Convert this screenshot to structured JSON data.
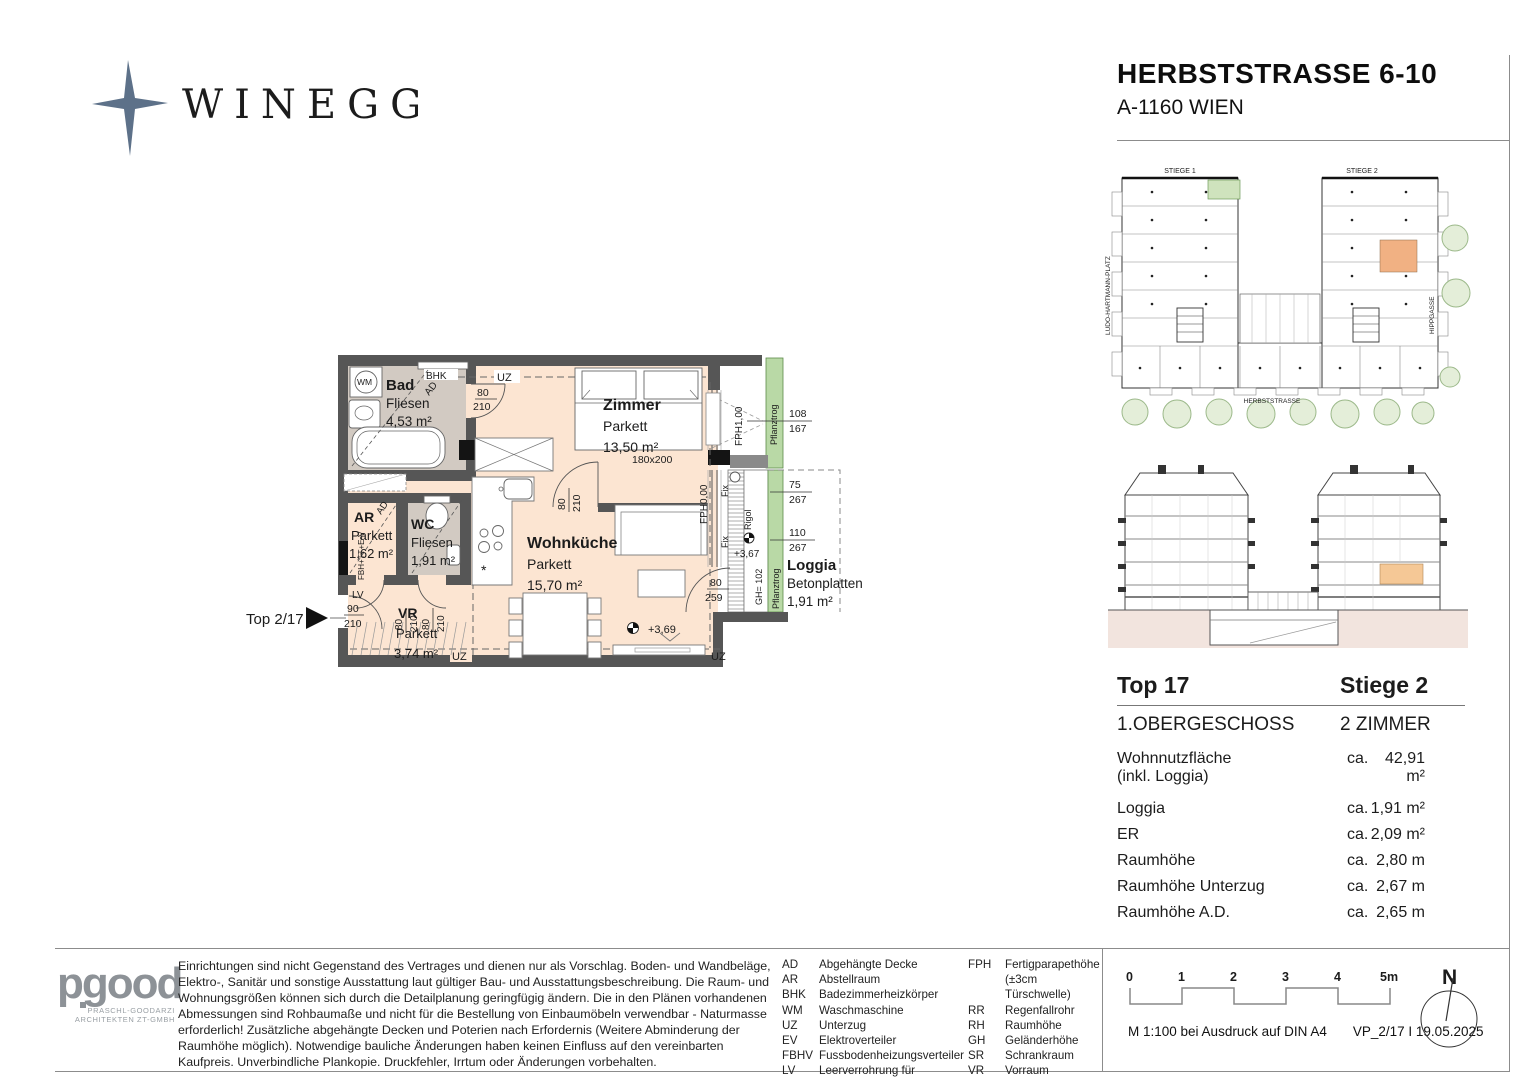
{
  "brand": {
    "name": "WINEGG",
    "color": "#5d7189"
  },
  "title": {
    "line1": "HERBSTSTRASSE 6-10",
    "line2": "A-1160 WIEN"
  },
  "site": {
    "stiege1": "STIEGE 1",
    "stiege2": "STIEGE 2",
    "left": "LUDO-HARTMANN-PLATZ",
    "right": "HIPPGASSE",
    "bottom": "HERBSTSTRASSE",
    "highlight_color": "#f1b183"
  },
  "plan": {
    "rooms": {
      "bad": {
        "name": "Bad",
        "floor": "Fliesen",
        "area": "4,53 m²"
      },
      "zimmer": {
        "name": "Zimmer",
        "floor": "Parkett",
        "area": "13,50 m²",
        "bed": "180x200"
      },
      "ar": {
        "name": "AR",
        "floor": "Parkett",
        "area": "1,62 m²"
      },
      "wc": {
        "name": "WC",
        "floor": "Fliesen",
        "area": "1,91 m²"
      },
      "vr": {
        "name": "VR",
        "floor": "Parkett",
        "area": "3,74 m²"
      },
      "wohn": {
        "name": "Wohnküche",
        "floor": "Parkett",
        "area": "15,70 m²"
      },
      "loggia": {
        "name": "Loggia",
        "floor": "Betonplatten",
        "area": "1,91 m²"
      }
    },
    "ann": {
      "wm": "WM",
      "bhk": "BHK",
      "uz": "UZ",
      "ad": "AD",
      "lv": "LV",
      "fbh": "FBH+TT+E-V",
      "fph1": "FPH1,00",
      "fph0": "FPH0,00",
      "fix": "Fix",
      "rigol": "Rigol",
      "pflanz": "Pflanztrog",
      "gh": "GH= 102",
      "lvl1": "+3,69",
      "lvl2": "+3,67",
      "top": "Top 2/17"
    },
    "dims": {
      "d80": "80",
      "d90": "90",
      "d210": "210",
      "d259": "259",
      "d75": "75",
      "d108": "108",
      "d110": "110",
      "d167": "167",
      "d267": "267"
    }
  },
  "info": {
    "top": "Top 17",
    "stiege": "Stiege 2",
    "floor": "1.OBERGESCHOSS",
    "rooms": "2 ZIMMER",
    "rows": [
      {
        "label": "Wohnnutzfläche",
        "label2": "(inkl. Loggia)",
        "prefix": "ca.",
        "value": "42,91 m²"
      },
      {
        "label": "Loggia",
        "prefix": "ca.",
        "value": "1,91 m²"
      },
      {
        "label": "ER",
        "prefix": "ca.",
        "value": "2,09 m²"
      },
      {
        "label": "Raumhöhe",
        "prefix": "ca.",
        "value": "2,80 m"
      },
      {
        "label": "Raumhöhe Unterzug",
        "prefix": "ca.",
        "value": "2,67 m"
      },
      {
        "label": "Raumhöhe A.D.",
        "prefix": "ca.",
        "value": "2,65 m"
      }
    ]
  },
  "footer": {
    "arch": {
      "logo": "pgood",
      "line1": "PRASCHL-GOODARZI",
      "line2": "ARCHITEKTEN ZT-GMBH"
    },
    "disclaimer": "Einrichtungen sind nicht Gegenstand des Vertrages und dienen nur als Vorschlag. Boden- und Wandbeläge, Elektro-, Sanitär und sonstige Ausstattung laut gültiger Bau- und Ausstattungsbeschreibung. Die Raum- und Wohnungsgrößen können sich durch die Detailplanung geringfügig ändern. Die in den Plänen vorhandenen Abmessungen sind Rohbaumaße und nicht für die Bestellung von Einbaumöbeln verwendbar - Naturmasse erforderlich! Zusätzliche abgehängte Decken und Poterien nach Erfordernis (Weitere Abminderung der Raumhöhe möglich). Notwendige bauliche Änderungen haben keinen Einfluss auf den vereinbarten Kaufpreis. Unverbindliche Plankopie. Druckfehler, Irrtum oder Änderungen vorbehalten.",
    "legend1": [
      {
        "a": "AD",
        "t": "Abgehängte Decke"
      },
      {
        "a": "AR",
        "t": "Abstellraum"
      },
      {
        "a": "BHK",
        "t": "Badezimmerheizkörper"
      },
      {
        "a": "WM",
        "t": "Waschmaschine"
      },
      {
        "a": "UZ",
        "t": "Unterzug"
      },
      {
        "a": "EV",
        "t": "Elektroverteiler"
      },
      {
        "a": "FBHV",
        "t": "Fussbodenheizungsverteiler"
      },
      {
        "a": "LV",
        "t": "Leerverrohrung für autom.Türöffner"
      }
    ],
    "legend2": [
      {
        "a": "FPH",
        "t": "Fertigparapethöhe",
        "t2": "(±3cm Türschwelle)"
      },
      {
        "a": "RR",
        "t": "Regenfallrohr"
      },
      {
        "a": "RH",
        "t": "Raumhöhe"
      },
      {
        "a": "GH",
        "t": "Geländerhöhe"
      },
      {
        "a": "SR",
        "t": "Schrankraum"
      },
      {
        "a": "VR",
        "t": "Vorraum"
      },
      {
        "a": "TA",
        "t": "Taster für autom.Türöffner"
      }
    ],
    "scale": {
      "ticks": [
        "0",
        "1",
        "2",
        "3",
        "4",
        "5m"
      ],
      "note": "M 1:100 bei Ausdruck auf DIN A4",
      "ref": "VP_2/17 I 19.05.2025"
    },
    "north": "N"
  }
}
